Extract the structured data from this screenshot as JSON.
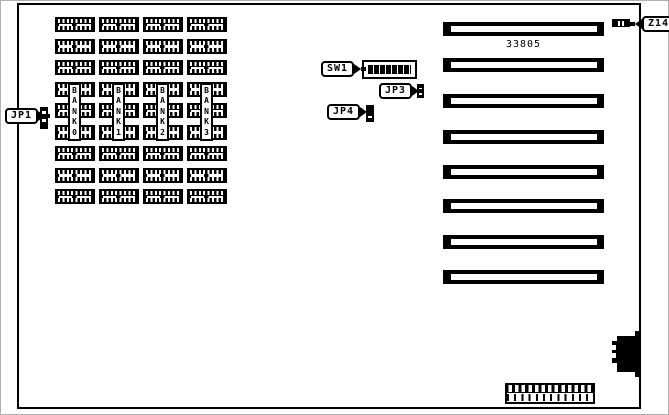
{
  "board": {
    "part_number": "33805",
    "colors": {
      "line": "#000000",
      "background": "#ffffff"
    }
  },
  "memory": {
    "chips_per_bank": 9,
    "banks": [
      {
        "label": "BANK 0"
      },
      {
        "label": "BANK 1"
      },
      {
        "label": "BANK 2"
      },
      {
        "label": "BANK 3"
      }
    ]
  },
  "expansion_slots": {
    "count": 8
  },
  "callouts": {
    "jp1": {
      "label": "JP1"
    },
    "sw1": {
      "label": "SW1"
    },
    "jp3": {
      "label": "JP3"
    },
    "jp4": {
      "label": "JP4"
    },
    "z14": {
      "label": "Z14"
    }
  },
  "components": {
    "dip_switch_positions": 8,
    "bottom_connector_pins": 12
  }
}
